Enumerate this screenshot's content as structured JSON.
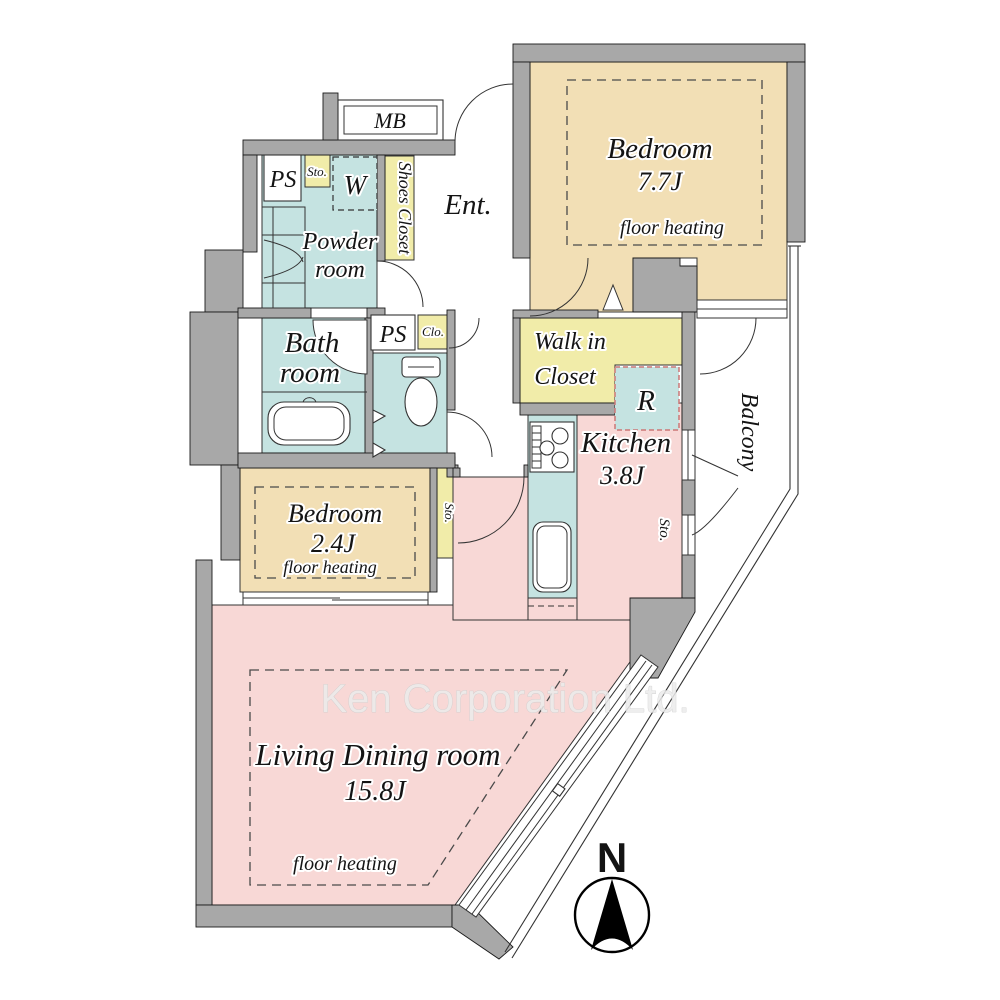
{
  "watermark": "Ken Corporation Ltd.",
  "compass": {
    "north_label": "N"
  },
  "colors": {
    "wall": "#a8a8a8",
    "bedroom": "#f2dfb5",
    "wet": "#c5e3e1",
    "closet": "#f1eca9",
    "living": "#f8d8d6",
    "watermark": "#ececec"
  },
  "labels": {
    "mb": "MB",
    "ps_upper": "PS",
    "sto_upper": "Sto.",
    "washer": "W",
    "shoes_closet": "Shoes Closet",
    "entrance": "Ent.",
    "bedroom1_name": "Bedroom",
    "bedroom1_size": "7.7J",
    "bedroom1_note": "floor heating",
    "powder_line1": "Powder",
    "powder_line2": "room",
    "bath_line1": "Bath",
    "bath_line2": "room",
    "ps_mid": "PS",
    "clo": "Clo.",
    "wic_line1": "Walk in",
    "wic_line2": "Closet",
    "fridge": "R",
    "kitchen_name": "Kitchen",
    "kitchen_size": "3.8J",
    "sto_kitchen": "Sto.",
    "balcony": "Balcony",
    "bedroom2_name": "Bedroom",
    "bedroom2_size": "2.4J",
    "bedroom2_note": "floor heating",
    "sto_bedroom": "Sto.",
    "living_name": "Living Dining room",
    "living_size": "15.8J",
    "living_note": "floor heating"
  }
}
